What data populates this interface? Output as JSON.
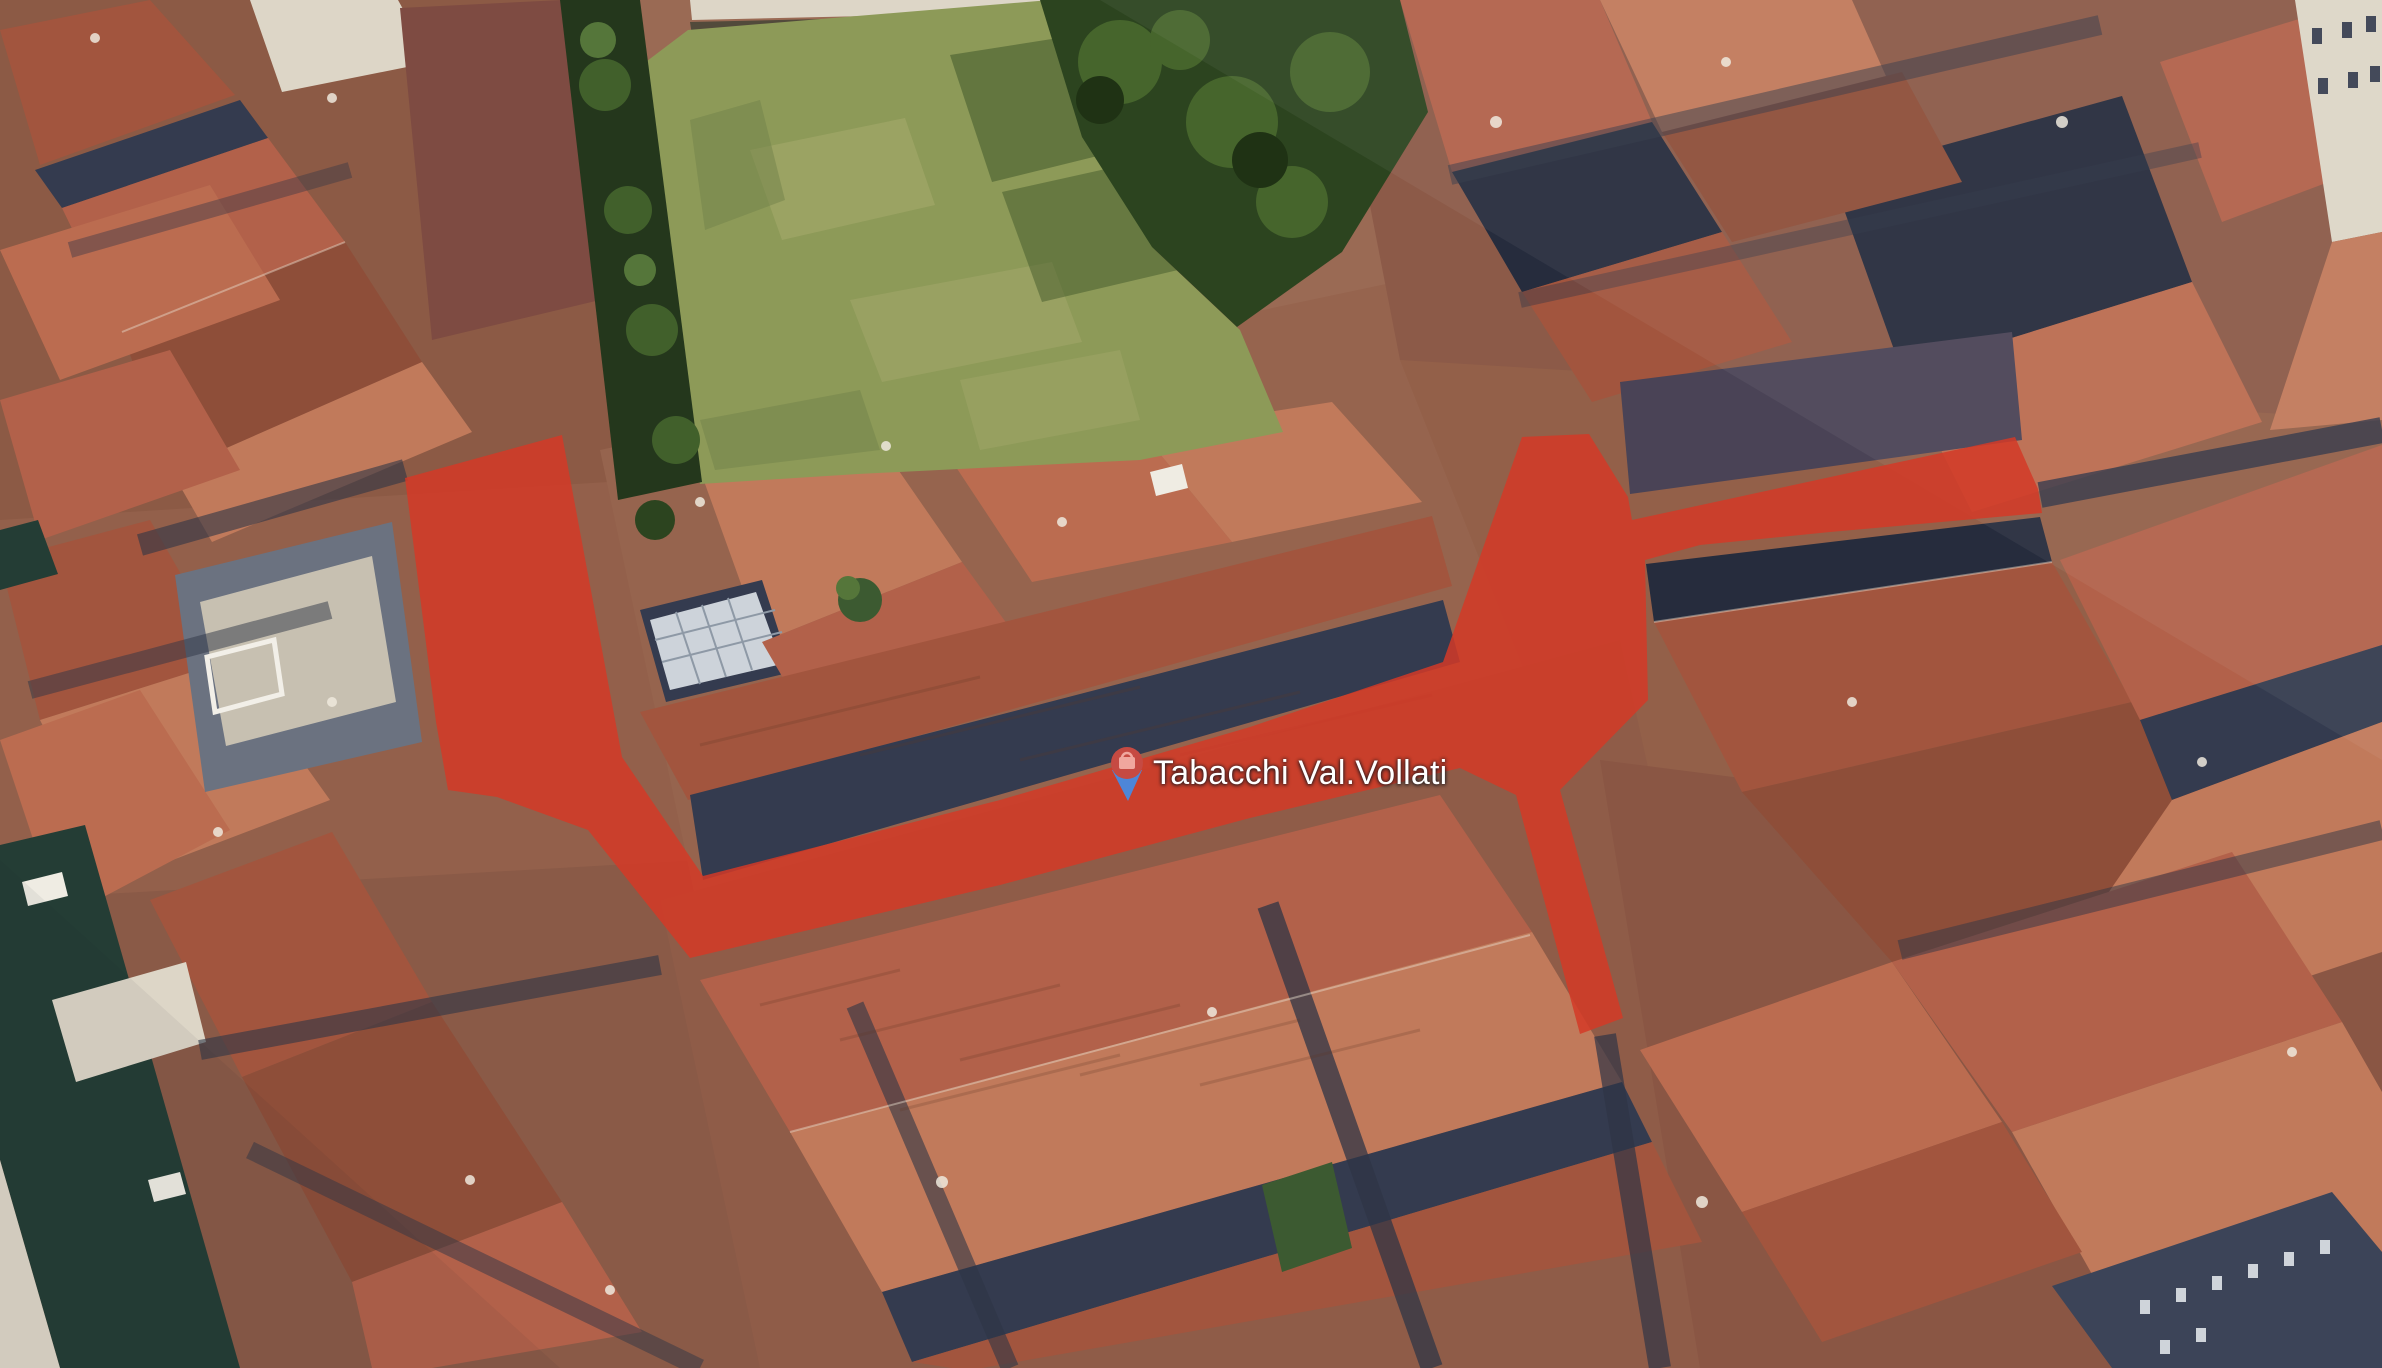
{
  "scene": {
    "description": "Aerial 3D satellite view of Venice rooftops, a grass field and a canal, with a red highlighted walking route over the streets",
    "poi": {
      "name": "Tabacchi Val.Vollati",
      "pin_icon": "shopping-bag-pin"
    }
  },
  "colors": {
    "route_highlight": "#d33a27",
    "pin_head": "#c64a42",
    "pin_bag": "#f0a79e",
    "pin_tip": "#4d86d8",
    "label_text": "#ffffff"
  },
  "route_overlay": {
    "opacity": "0.85",
    "points": "405,478 562,435 622,757 703,876 1000,800 1250,727 1443,662 1522,437 1589,434 1628,497 1632,520 2015,437 2038,489 2042,513 1830,532 1700,545 1645,560 1648,700 1560,790 1623,1018 1580,1034 1516,795 1460,768 1250,818 1000,885 690,958 588,830 497,797 448,790 436,722"
  }
}
